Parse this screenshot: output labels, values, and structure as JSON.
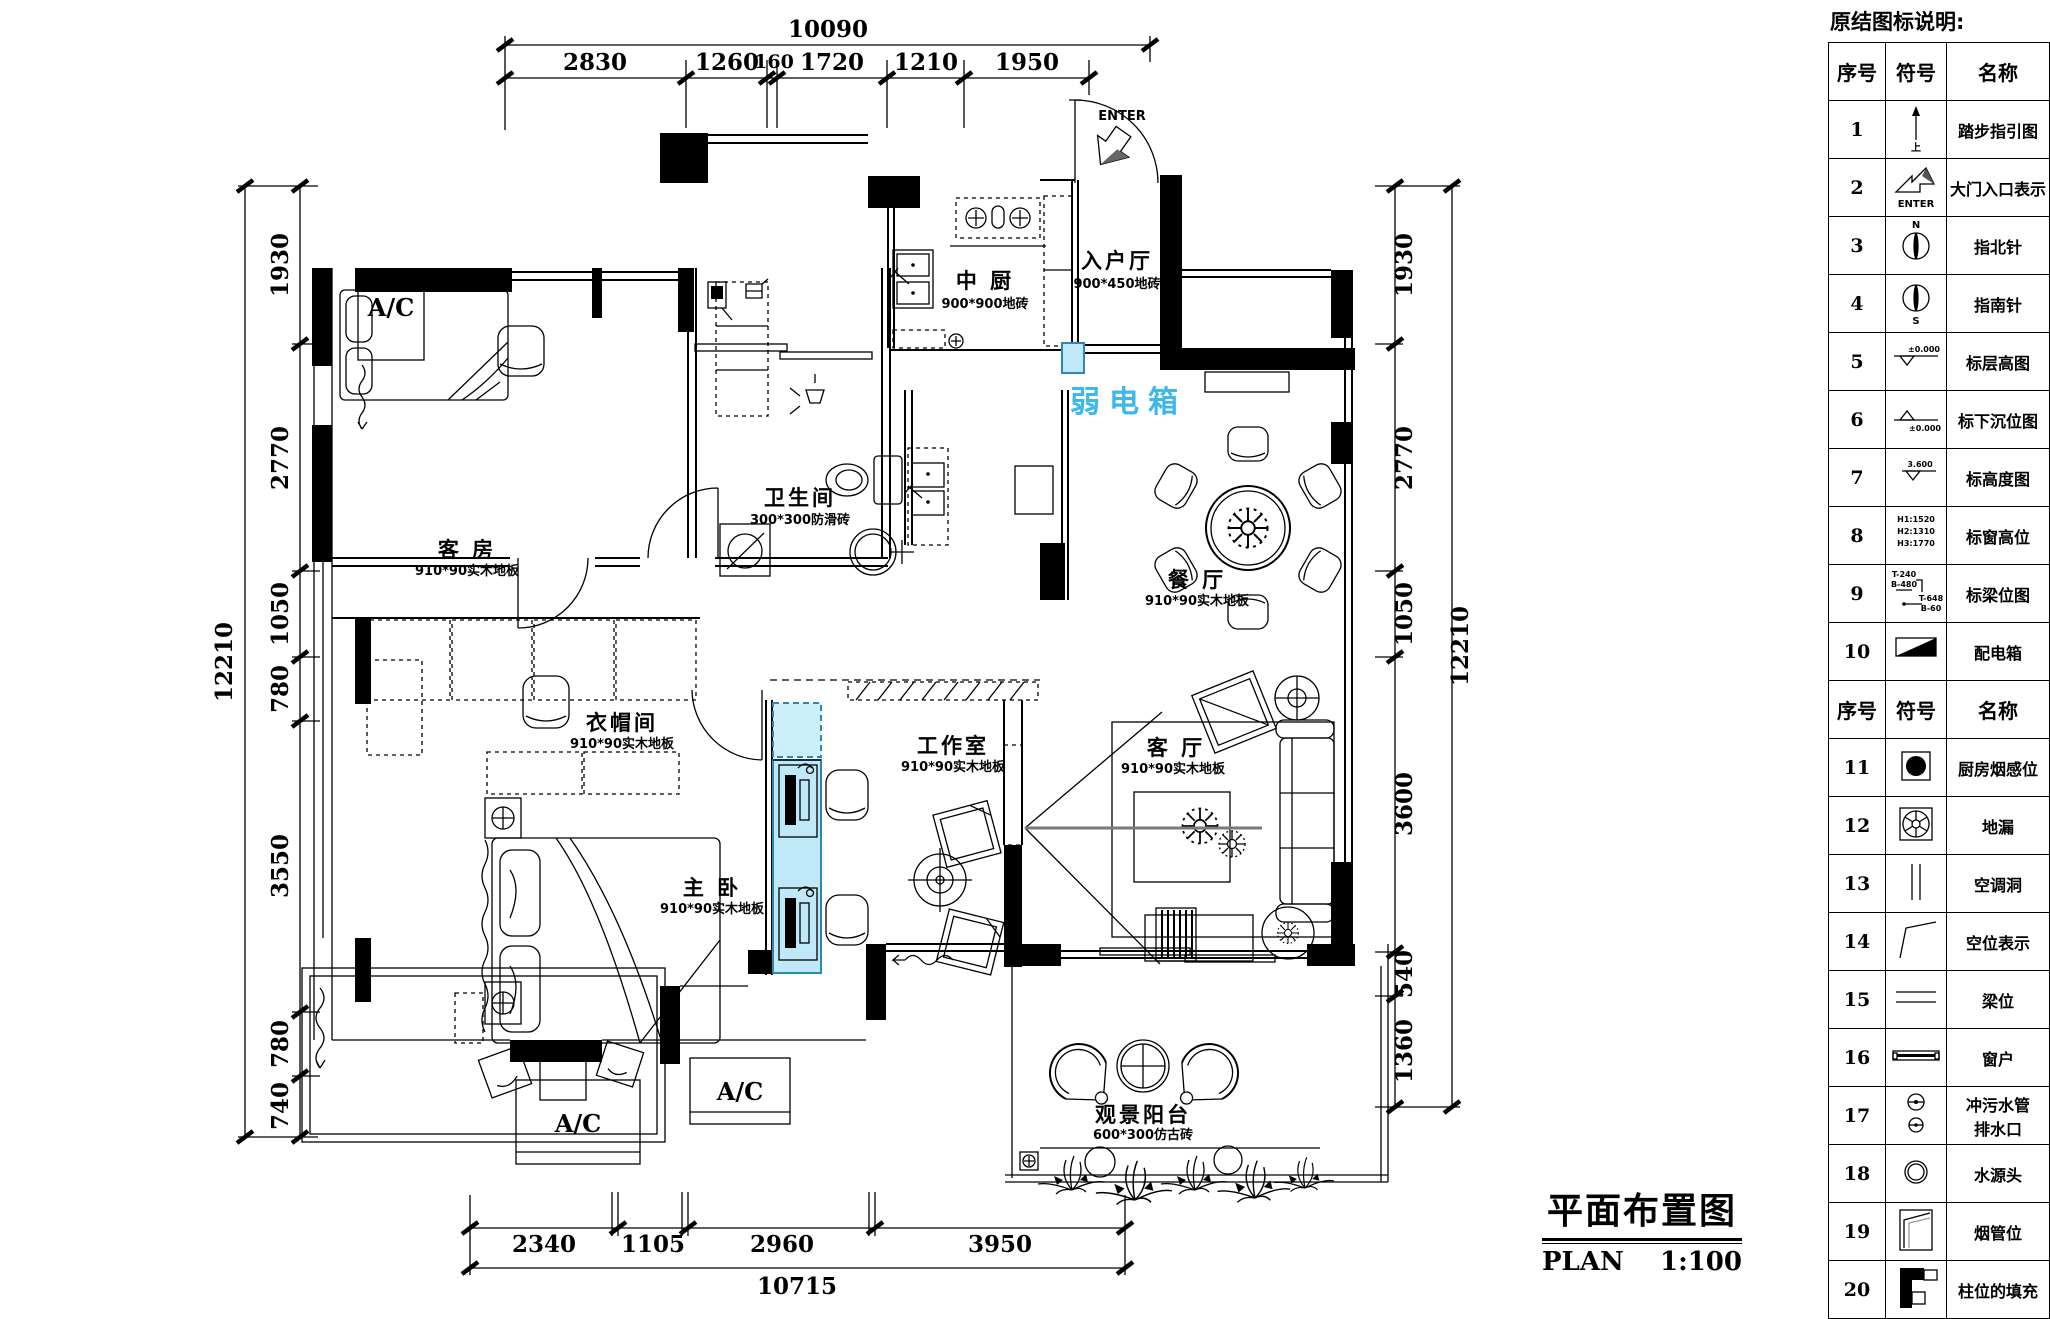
{
  "page": {
    "background": "#ffffff",
    "line_color": "#000000",
    "highlight_fill": "#bfe9f9",
    "highlight_stroke": "#2e86b5",
    "highlight_text_color": "#3db8ec"
  },
  "title_block": {
    "title": "平面布置图",
    "code": "PLAN",
    "scale": "1:100"
  },
  "weak_current_box": {
    "label": "弱电箱"
  },
  "entry": {
    "enter_label": "ENTER"
  },
  "ac_unit_label": "A/C",
  "rooms": [
    {
      "name": "中 厨",
      "spec": "900*900地砖"
    },
    {
      "name": "入户厅",
      "spec": "900*450地砖"
    },
    {
      "name": "西 厨",
      "spec": "900*900地砖"
    },
    {
      "name": "卫生间",
      "spec": "300*300防滑砖"
    },
    {
      "name": "客 房",
      "spec": "910*90实木地板"
    },
    {
      "name": "餐 厅",
      "spec": "910*90实木地板"
    },
    {
      "name": "衣帽间",
      "spec": "910*90实木地板"
    },
    {
      "name": "工作室",
      "spec": "910*90实木地板"
    },
    {
      "name": "客 厅",
      "spec": "910*90实木地板"
    },
    {
      "name": "主 卧",
      "spec": "910*90实木地板"
    },
    {
      "name": "观景阳台",
      "spec": "600*300仿古砖"
    }
  ],
  "dims": {
    "top": {
      "total": "10090",
      "segments": [
        "2830",
        "1260",
        "160",
        "1720",
        "1210",
        "1950"
      ]
    },
    "left": {
      "total": "12210",
      "segments": [
        "1930",
        "2770",
        "1050",
        "780",
        "3550",
        "780",
        "740"
      ]
    },
    "right": {
      "total": "12210",
      "segments": [
        "1930",
        "2770",
        "1050",
        "3600",
        "540",
        "1360"
      ]
    },
    "bottom": {
      "total": "10715",
      "segments": [
        "2340",
        "1105",
        "2960",
        "3950"
      ]
    }
  },
  "legend": {
    "title": "原结图标说明:",
    "headers": {
      "no": "序号",
      "symbol": "符号",
      "name": "名称"
    },
    "rows": [
      {
        "no": "1",
        "name": "踏步指引图",
        "text": "上"
      },
      {
        "no": "2",
        "name": "大门入口表示",
        "text": "ENTER"
      },
      {
        "no": "3",
        "name": "指北针",
        "text": "N"
      },
      {
        "no": "4",
        "name": "指南针",
        "text": "S"
      },
      {
        "no": "5",
        "name": "标层高图",
        "text": "±0.000"
      },
      {
        "no": "6",
        "name": "标下沉位图",
        "text": "±0.000"
      },
      {
        "no": "7",
        "name": "标高度图",
        "text": "3.600"
      },
      {
        "no": "8",
        "name": "标窗高位",
        "lines": [
          "H1:1520",
          "H2:1310",
          "H3:1770"
        ]
      },
      {
        "no": "9",
        "name": "标梁位图",
        "t1": "T-240",
        "t2": "B-480",
        "t3": "T-648",
        "t4": "B-60"
      },
      {
        "no": "10",
        "name": "配电箱"
      },
      {
        "no": "11",
        "name": "厨房烟感位"
      },
      {
        "no": "12",
        "name": "地漏"
      },
      {
        "no": "13",
        "name": "空调洞"
      },
      {
        "no": "14",
        "name": "空位表示"
      },
      {
        "no": "15",
        "name": "梁位"
      },
      {
        "no": "16",
        "name": "窗户"
      },
      {
        "no": "17",
        "name": "冲污水管",
        "name2": "排水口"
      },
      {
        "no": "18",
        "name": "水源头"
      },
      {
        "no": "19",
        "name": "烟管位"
      },
      {
        "no": "20",
        "name": "柱位的填充"
      }
    ]
  }
}
